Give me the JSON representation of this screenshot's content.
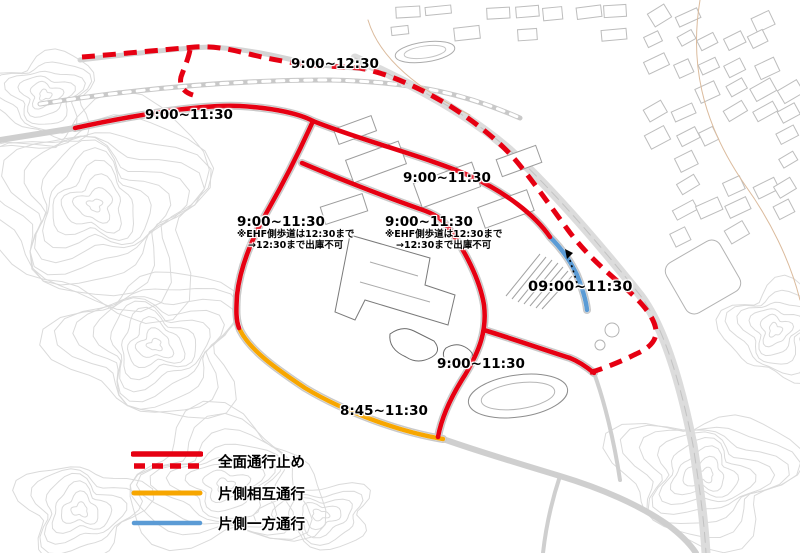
{
  "map_labels": [
    {
      "id": "t1",
      "text": "9:00~12:30"
    },
    {
      "id": "t2",
      "text": "9:00~11:30"
    },
    {
      "id": "t3",
      "text": "9:00~11:30"
    },
    {
      "id": "t4",
      "text": "9:00~11:30",
      "note1": "※EHF側歩道は12:30まで",
      "note2": "→12:30まで出庫不可"
    },
    {
      "id": "t5",
      "text": "9:00~11:30",
      "note1": "※EHF側歩道は12:30まで",
      "note2": "→12:30まで出庫不可"
    },
    {
      "id": "t6",
      "text": "09:00~11:30"
    },
    {
      "id": "t7",
      "text": "9:00~11:30"
    },
    {
      "id": "t8",
      "text": "8:45~11:30"
    }
  ],
  "legend": {
    "items": [
      {
        "label": "全面通行止め",
        "type": "full-closure"
      },
      {
        "label": "片側相互通行",
        "type": "alternating-single-lane"
      },
      {
        "label": "片側一方通行",
        "type": "one-way-single-lane"
      }
    ]
  },
  "colors": {
    "closure_red": "#e60012",
    "alternating_yellow": "#f7a600",
    "one_way_blue": "#5b9bd5"
  }
}
